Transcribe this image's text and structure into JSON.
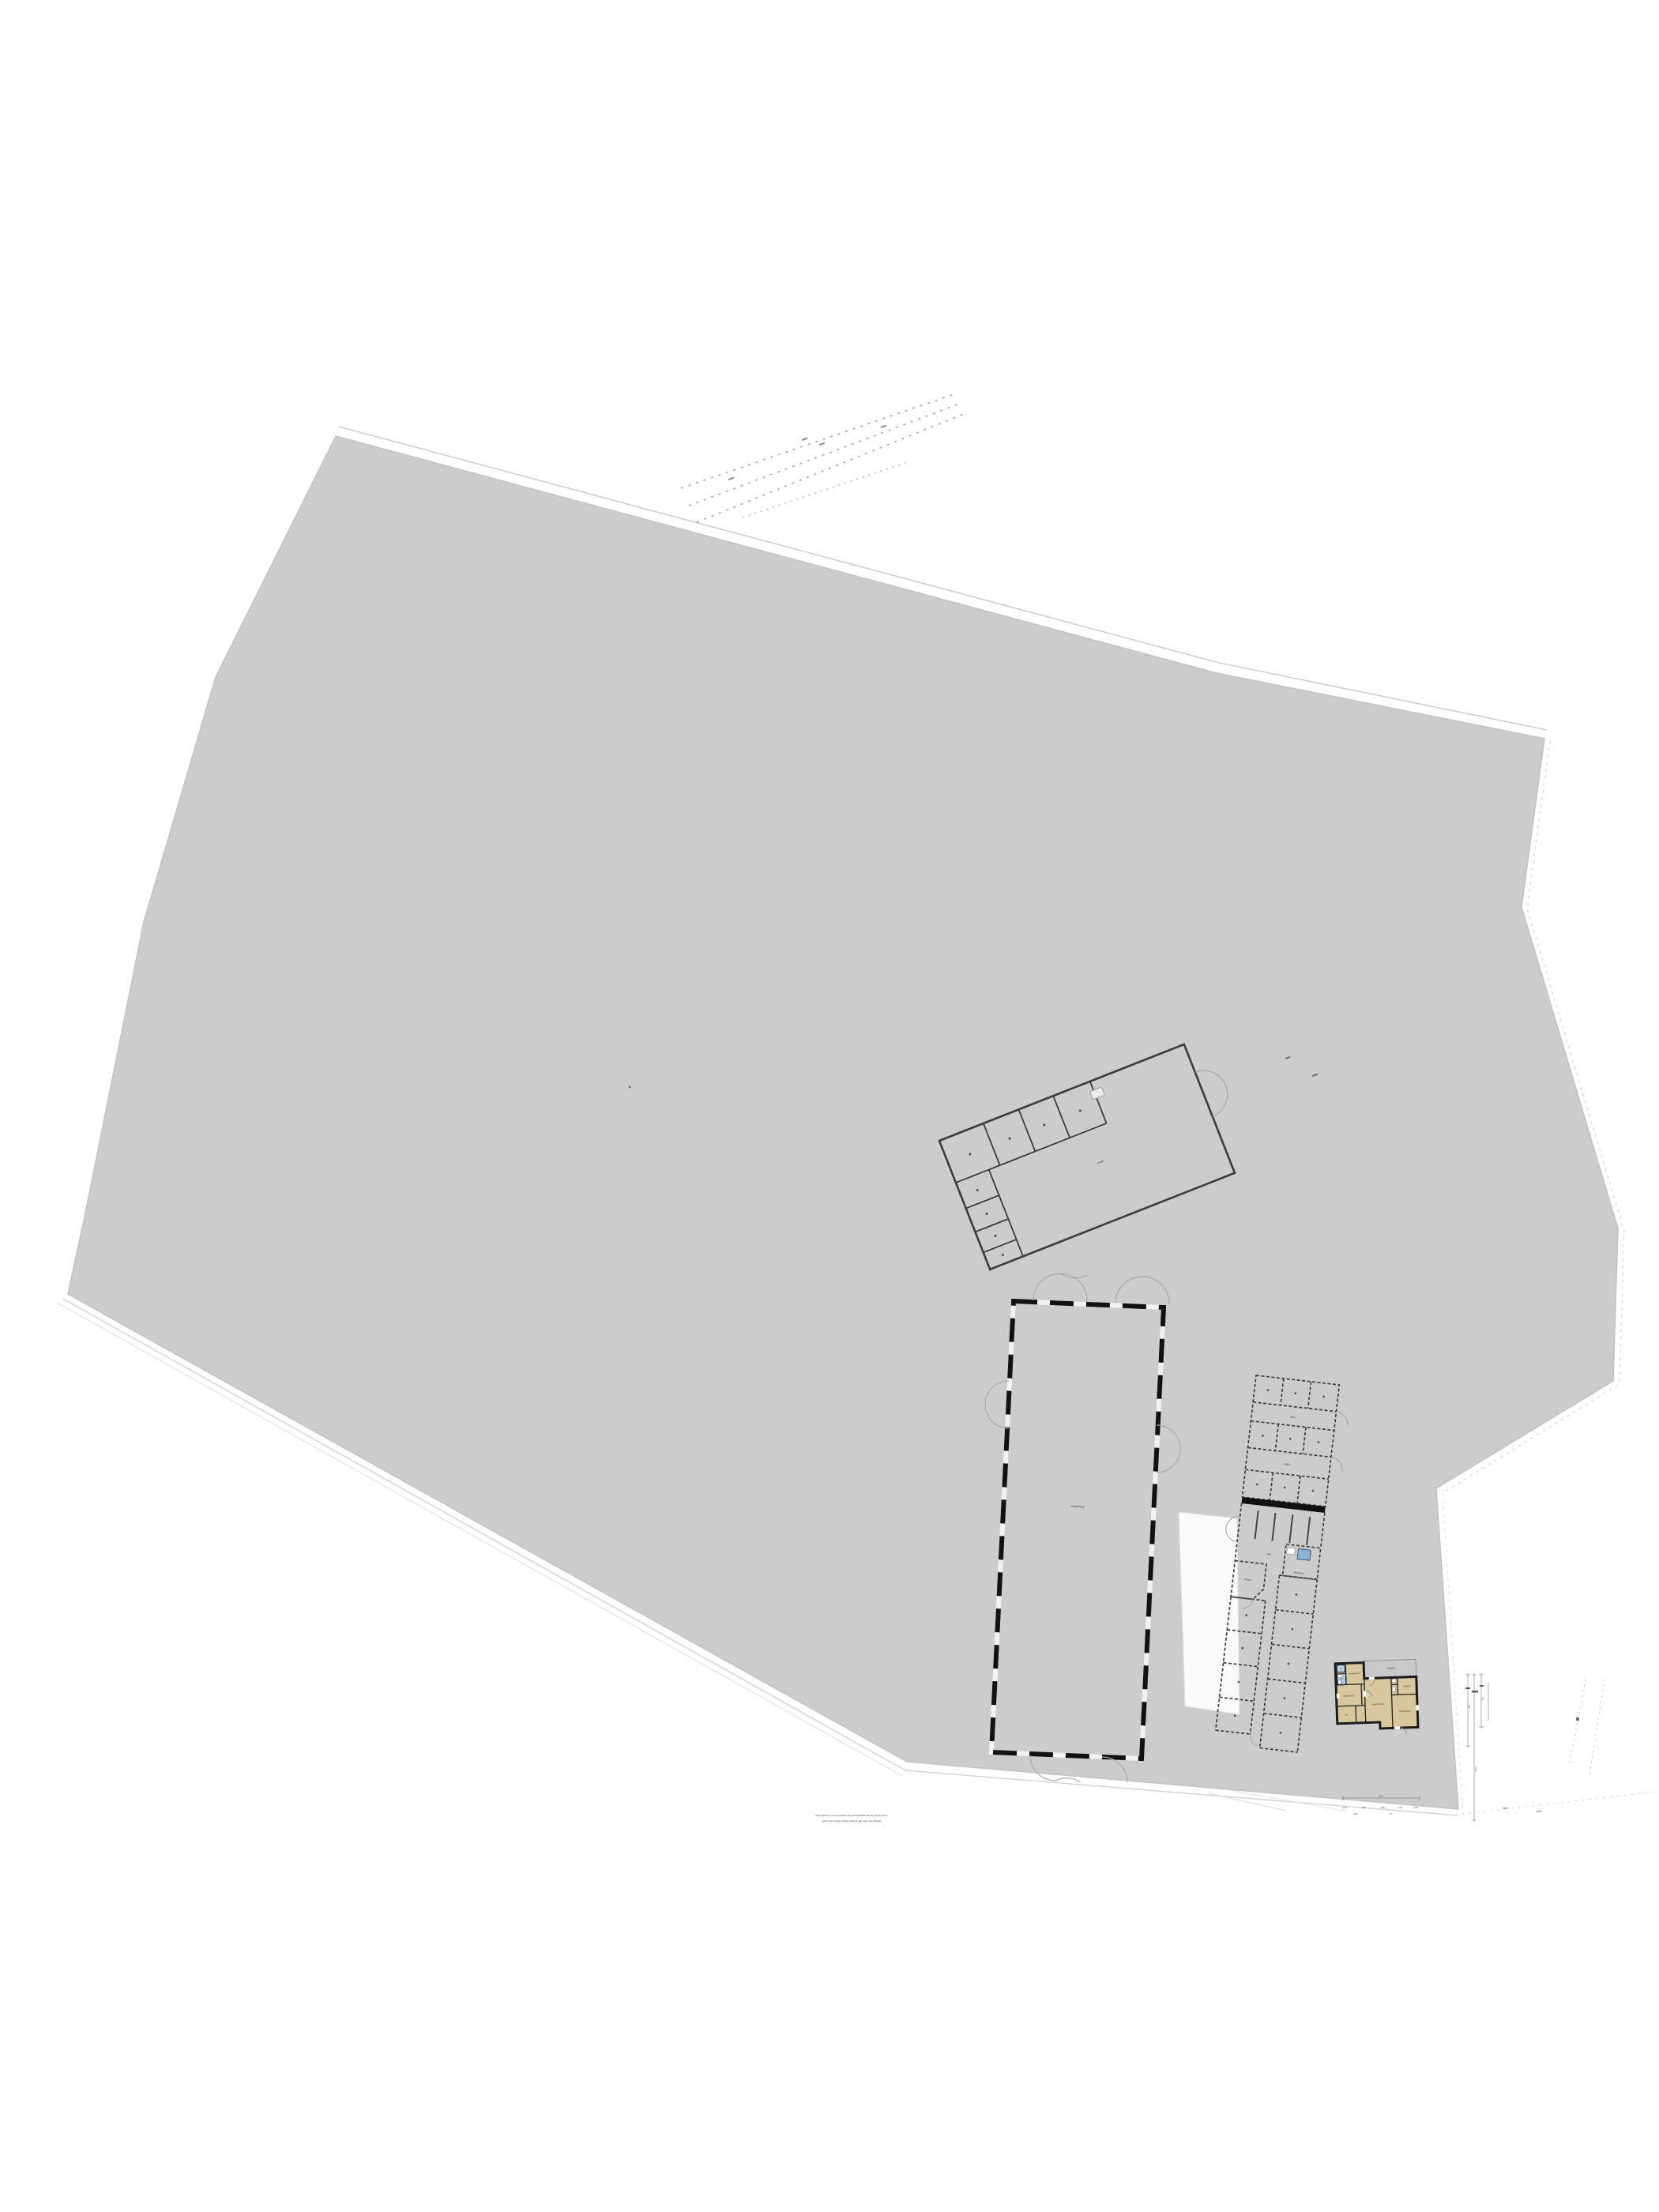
{
  "drawing": {
    "type_hint": "situatietekening / site plan with floor plans",
    "colors": {
      "parcel_fill": "#cccccc",
      "wall_dark": "#1b1b1b",
      "house_room_tan": "#d8c79c",
      "house_wet_blue": "#a9c6e0",
      "house_closet_blue": "#bcd4ea",
      "garage_grey": "#c9c9c9",
      "boundary_faint": "#c9c9c9"
    }
  },
  "disclaimer": {
    "line1": "Deze tekening is met de grootste zorg samengesteld, aan de inhoud kunnen",
    "line2": "echter geen rechten worden ontleend, alle maten zijn indicatief"
  },
  "scalebar": {
    "total": "14.8",
    "ticks": [
      "2.10",
      "4.95",
      "3.20",
      "2.40",
      "1.85"
    ],
    "row2": [
      "10.2",
      "7.5"
    ]
  },
  "vdims": {
    "a": "8.4",
    "b": "12.6",
    "c": "5.2"
  },
  "workshop": {
    "label": "loods"
  },
  "shed": {
    "label": "veldschuur"
  },
  "stable": {
    "corridor1": "gang",
    "corridor2": "gang",
    "stalls": "stal",
    "tackroom": "berging",
    "washroom": "wasplaats"
  },
  "house": {
    "closet": "kast",
    "bath": "badkamer",
    "bed_top": "slaapkamer",
    "bed_left": "slaapkamer",
    "hall": "hal",
    "living": "woonkamer",
    "kitchen": "keuken",
    "bed_right": "slaapkamer",
    "garage": "berging"
  }
}
